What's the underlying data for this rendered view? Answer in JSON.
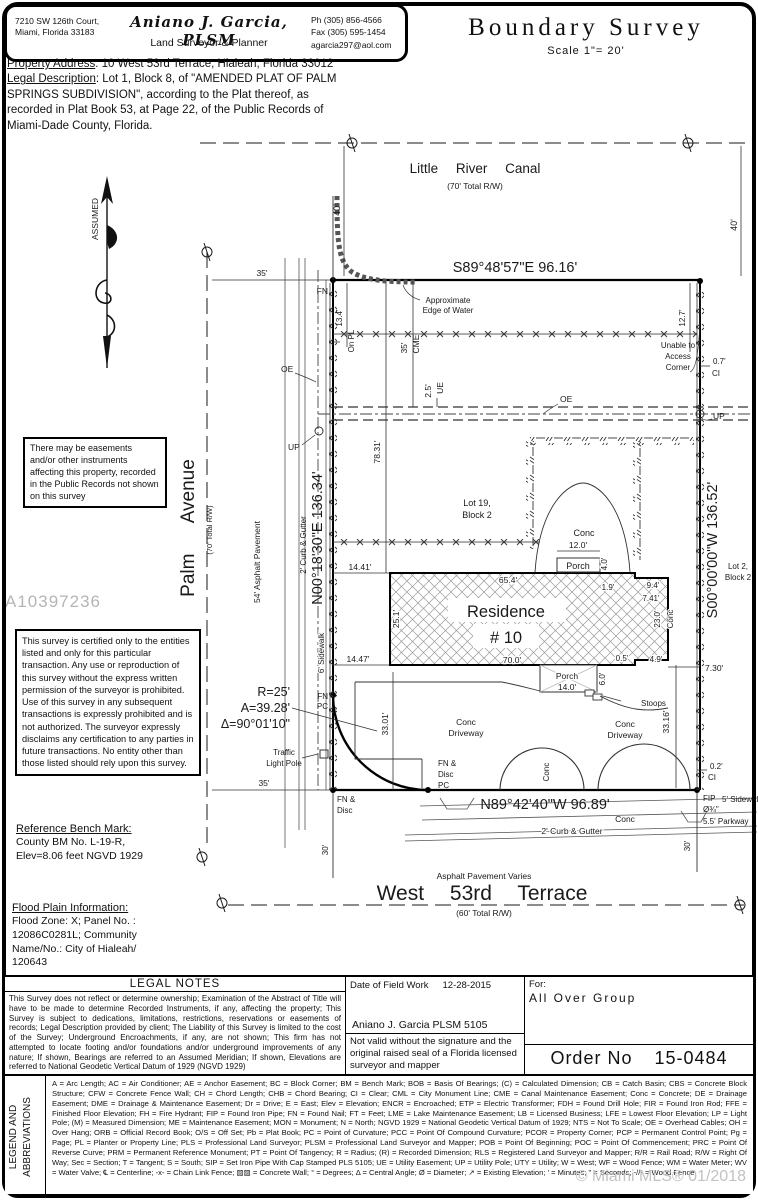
{
  "header": {
    "address": "7210 SW 126th Court,\nMiami, Florida 33183",
    "surveyor_name": "Aniano J. Garcia, PLSM",
    "surveyor_title": "Land Surveyor & Planner",
    "contact": "Ph (305) 856-4566\nFax (305) 595-1454\nagarcia297@aol.com",
    "doc_title": "Boundary Survey",
    "scale": "Scale 1\"= 20'"
  },
  "property": {
    "address_label": "Property Address",
    "address_value": ": 10 West 53rd Terrace, Hialeah, Florida 33012",
    "legal_label": "Legal Description",
    "legal_value": ": Lot 1, Block 8, of \"AMENDED PLAT OF PALM SPRINGS SUBDIVISION\", according to the Plat thereof, as recorded in Plat Book 53, at Page 22, of the Public Records of Miami-Dade County, Florida."
  },
  "notes": {
    "easements": "There may be easements and/or other instruments affecting this property, recorded in the Public Records not shown on this survey",
    "certification": "This survey is certified only to the entities listed and only for this particular transaction. Any use or reproduction of this survey without the express written permission of the surveyor is prohibited. Use of this survey in any subsequent transactions is expressly prohibited and is not authorized. The surveyor expressly disclaims any certification to any parties in future transactions. No entity other than those listed should rely upon this survey.",
    "bench_title": "Reference Bench Mark:",
    "bench_body": "County BM No. L-19-R,\nElev=8.06 feet NGVD 1929",
    "flood_title": "Flood Plain Information:",
    "flood_body": "Flood Zone: X; Panel No. :\n12086C0281L; Community\nName/No.: City of Hialeah/\n120643"
  },
  "watermarks": {
    "id": "A10397236",
    "mls": "© Miami MLS® 01/2018"
  },
  "drawing": {
    "canal_name": "Little River Canal",
    "rw70": "(70' Total R/W)",
    "dim_40": "40'",
    "north_bearing": "S89°48'57\"E 96.16'",
    "unable": [
      "Unable to",
      "Access",
      "Corner"
    ],
    "fn": "FN",
    "approx": [
      "Approximate",
      "Edge of Water"
    ],
    "dim_13_4": "13.4'",
    "dim_12_7": "12.7'",
    "dim_35": "35'",
    "on_pl": "On PL",
    "dim_cme_35": "35'",
    "cme": "CME",
    "dim_0_7": "0.7'",
    "ci": "CI",
    "oe": "OE",
    "dim_2_5": "2.5'",
    "ue": "UE",
    "up": "UP",
    "dim_78_31": "78.31'",
    "lot19": [
      "Lot 19,",
      "Block 2"
    ],
    "conc": "Conc",
    "dim_12_0": "12.0'",
    "porch": "Porch",
    "dim_4_0": "4.0'",
    "dim_14_41": "14.41'",
    "dim_65_4": "65.4'",
    "dim_1_9": "1.9'",
    "dim_9_4": "9.4'",
    "dim_7_41": "7.41'",
    "residence": [
      "Residence",
      "# 10"
    ],
    "dim_25_1": "25.1'",
    "dim_23_0": "23.0'",
    "dim_14_47": "14.47'",
    "dim_70_0": "70.0'",
    "dim_0_5": "0.5'",
    "dim_4_9": "4.9'",
    "dim_7_30": "7.30'",
    "east_bearing": "S00°00'00\"W  136.52'",
    "lot2": [
      "Lot 2,",
      "Block 2"
    ],
    "west_bearing": "N00°18'30\"E 136.34'",
    "asphalt_54": "54' Asphalt Pavement",
    "curb_gutter": "2' Curb & Gutter",
    "sidewalk_6": "6' Sidewalk",
    "radius": "R=25'",
    "arc_len": "A=39.28'",
    "delta": "Δ=90°01'10\"",
    "pc": "PC",
    "traffic": [
      "Traffic",
      "Light Pole"
    ],
    "fn_disc": [
      "FN &",
      "Disc"
    ],
    "dim_33_01": "33.01'",
    "dim_33_16": "33.16'",
    "driveway": "Driveway",
    "dim_14_0": "14.0'",
    "dim_6_0": "6.0'",
    "stoops": "Stoops",
    "south_bearing": "N89°42'40\"W 96.89'",
    "dim_0_2": "0.2'",
    "fip": "FIP",
    "fip_dia": "Ø¾\"",
    "sidewalk_5": "5' Sidewalk",
    "parkway": "5.5' Parkway",
    "dim_30": "30'",
    "asphalt_varies": "Asphalt Pavement Varies",
    "street_name": "West 53rd Terrace",
    "rw60": "(60' Total R/W)",
    "palm": "Palm Avenue",
    "assumed": "ASSUMED"
  },
  "footer": {
    "legal_notes_title": "LEGAL NOTES",
    "legal_notes_body": "This Survey does not reflect or determine ownership; Examination of the Abstract of Title will have to be made to determine Recorded Instruments, if any, affecting the property; This Survey is subject to dedications, limitations, restrictions, reservations or easements of records; Legal Description provided by client; The Liability of this Survey is limited to the cost of the Survey; Underground Encroachments, if any, are not shown; This firm has not attempted to locate footing and/or foundations and/or underground improvements of any nature; If shown, Bearings are referred to an Assumed Meridian; If shown, Elevations are referred to National Geodetic Vertical Datum of 1929 (NGVD 1929)",
    "field_work_label": "Date of Field Work",
    "field_work_date": "12-28-2015",
    "surveyor_sig": "Aniano J. Garcia PLSM 5105",
    "validity": "Not valid without the signature and the original raised seal of a Florida licensed surveyor and mapper",
    "for_label": "For:",
    "client": "All Over Group",
    "order_label": "Order No",
    "order_no": "15-0484",
    "legend_title_1": "LEGEND AND",
    "legend_title_2": "ABBREVIATIONS",
    "abbreviations": "A = Arc Length; AC = Air Conditioner; AE = Anchor Easement; BC = Block Corner; BM = Bench Mark; BOB = Basis Of Bearings; (C) = Calculated Dimension; CB = Catch Basin; CBS = Concrete Block Structure; CFW = Concrete Fence Wall; CH = Chord Length; CHB = Chord Bearing; CI = Clear; CML = City Monument Line; CME = Canal Maintenance Easement; Conc = Concrete; DE = Drainage Easement; DME = Drainage & Maintenance Easement; Dr = Drive; E = East; Elev = Elevation; ENCR = Encroached; ETP = Electric Transformer; FDH = Found Drill Hole; FIR = Found Iron Rod; FFE = Finished Floor Elevation; FH = Fire Hydrant; FIP = Found Iron Pipe; FN = Found Nail; FT = Feet; LME = Lake Maintenance Easement; LB = Licensed Business; LFE = Lowest Floor Elevation; LP = Light Pole; (M) = Measured Dimension; ME = Maintenance Easement; MON = Monument; N = North; NGVD 1929 = National Geodetic Vertical Datum of 1929; NTS = Not To Scale; OE = Overhead Cables; OH = Over Hang; ORB = Official Record Book; O/S = Off Set; Pb = Plat Book; PC = Point of Curvature; PCC = Point Of Compound Curvature; PCOR = Property Corner; PCP = Permanent Control Point; Pg = Page; PL = Planter or Property Line; PLS = Professional Land Surveyor; PLSM = Professional Land Surveyor and Mapper; POB = Point Of Beginning; POC = Point Of Commencement; PRC = Point Of Reverse Curve; PRM = Permanent Reference Monument; PT = Point Of Tangency; R = Radius; (R) = Recorded Dimension; RLS = Registered Land Surveyor and Mapper; R/R = Rail Road; R/W = Right Of Way; Sec = Section; T = Tangent; S = South; SIP = Set Iron Pipe With Cap Stamped PLS 5105; UE = Utility Easement; UP = Utility Pole; UTY = Utility; W = West; WF = Wood Fence; WM = Water Meter; WV = Water Valve; ℄ = Centerline; -x- = Chain Link Fence; ▨▨ = Concrete Wall; ° = Degrees; Δ = Central Angle; Ø = Diameter; ↗ = Existing Elevation; ' = Minutes; \" = Seconds; -//- = Wood Fence"
  }
}
